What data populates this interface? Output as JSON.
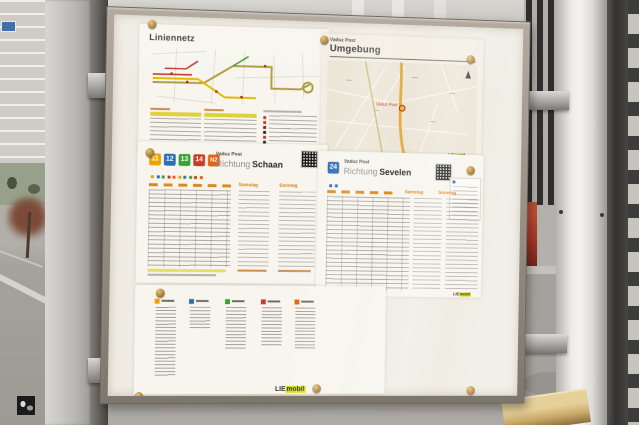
{
  "board": {
    "liniennetz": {
      "title": "Liniennetz"
    },
    "umgebung": {
      "kicker": "Vaduz Post",
      "title": "Umgebung",
      "map_label": "Vaduz Post"
    },
    "schaan": {
      "kicker": "Vaduz Post",
      "richtung_label": "Richtung",
      "destination": "Schaan",
      "badges": [
        {
          "label": "11",
          "color": "#eaa400"
        },
        {
          "label": "12",
          "color": "#2e6eb5"
        },
        {
          "label": "13",
          "color": "#38a12f"
        },
        {
          "label": "14",
          "color": "#cf3a28"
        },
        {
          "label": "N2",
          "color": "#e06414"
        }
      ],
      "day_columns": [
        "Samstag",
        "Sonntag"
      ]
    },
    "sevelen": {
      "kicker": "Vaduz Post",
      "richtung_label": "Richtung",
      "destination": "Sevelen",
      "badge": {
        "label": "24",
        "color": "#2e6eb5"
      },
      "day_columns": [
        "Samstag",
        "Sonntag"
      ]
    },
    "operator_logo": {
      "lie": "LIE",
      "mobil": "mobil",
      "accent_color": "#d9dd00"
    },
    "route_line_colors": {
      "11": "#eaa400",
      "12": "#2e6eb5",
      "13": "#38a12f",
      "14": "#cf3a28",
      "N2": "#e06414",
      "24": "#2e6eb5"
    }
  }
}
